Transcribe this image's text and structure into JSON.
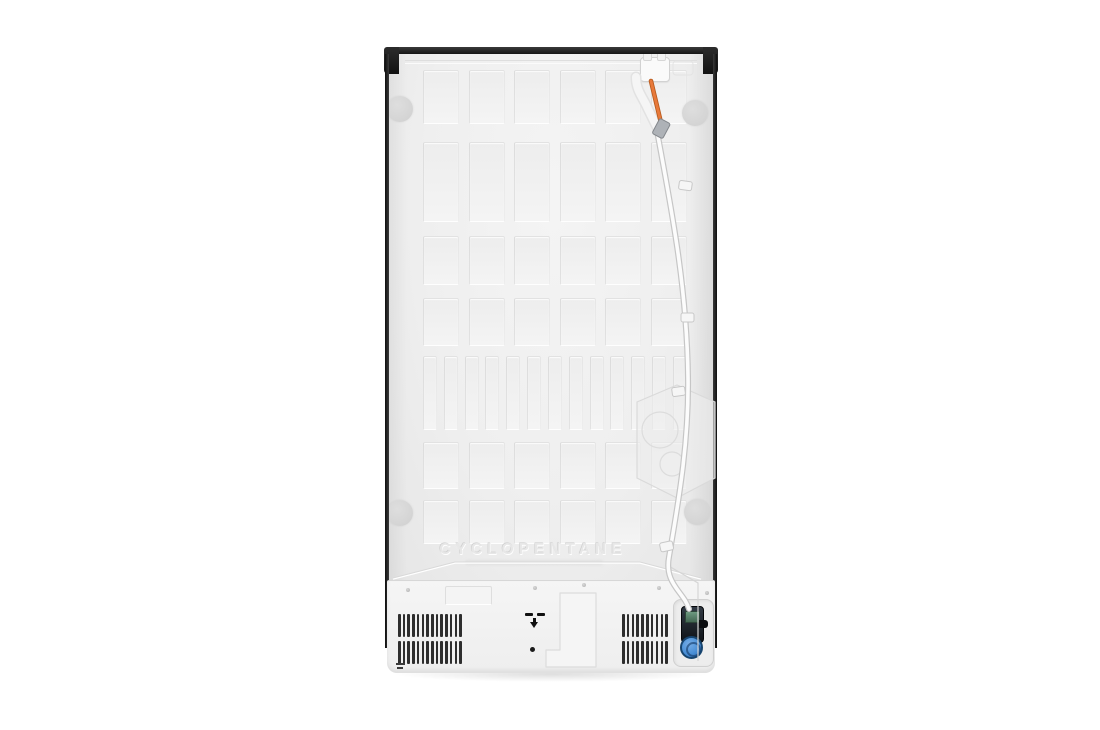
{
  "scene": {
    "subject": "Rear view of a refrigerator (product photo)",
    "background": "#ffffff"
  },
  "embossed": {
    "material_label": "CYCLOPENTANE"
  },
  "colors": {
    "trim_black": "#1a1a1a",
    "panel": "#efefef",
    "machine_cover": "#f2f2f2",
    "spacer_pad": "#d6d6d6",
    "orange_tube": "#e2712b",
    "water_tube": "#fcfcfc",
    "tube_outline": "#c6c6c6",
    "valve_body": "#141922",
    "valve_cap_blue": "#4a8fd6",
    "valve_label_green": "#5d8a6b",
    "vent_slat": "#2e2e2e"
  },
  "slot_grid": {
    "rows": [
      {
        "y": 23,
        "h": 52,
        "cols": 6,
        "slot_w": 34
      },
      {
        "y": 95,
        "h": 78,
        "cols": 6,
        "slot_w": 34
      },
      {
        "y": 189,
        "h": 47,
        "cols": 6,
        "slot_w": 34
      },
      {
        "y": 251,
        "h": 46,
        "cols": 6,
        "slot_w": 34
      },
      {
        "y": 309,
        "h": 72,
        "cols": 13,
        "slot_w": 12
      },
      {
        "y": 395,
        "h": 45,
        "cols": 6,
        "slot_w": 34
      },
      {
        "y": 453,
        "h": 42,
        "cols": 6,
        "slot_w": 34
      }
    ]
  },
  "vents": {
    "rows": 2,
    "left": {
      "slats": 14
    },
    "right": {
      "slats": 10
    }
  }
}
